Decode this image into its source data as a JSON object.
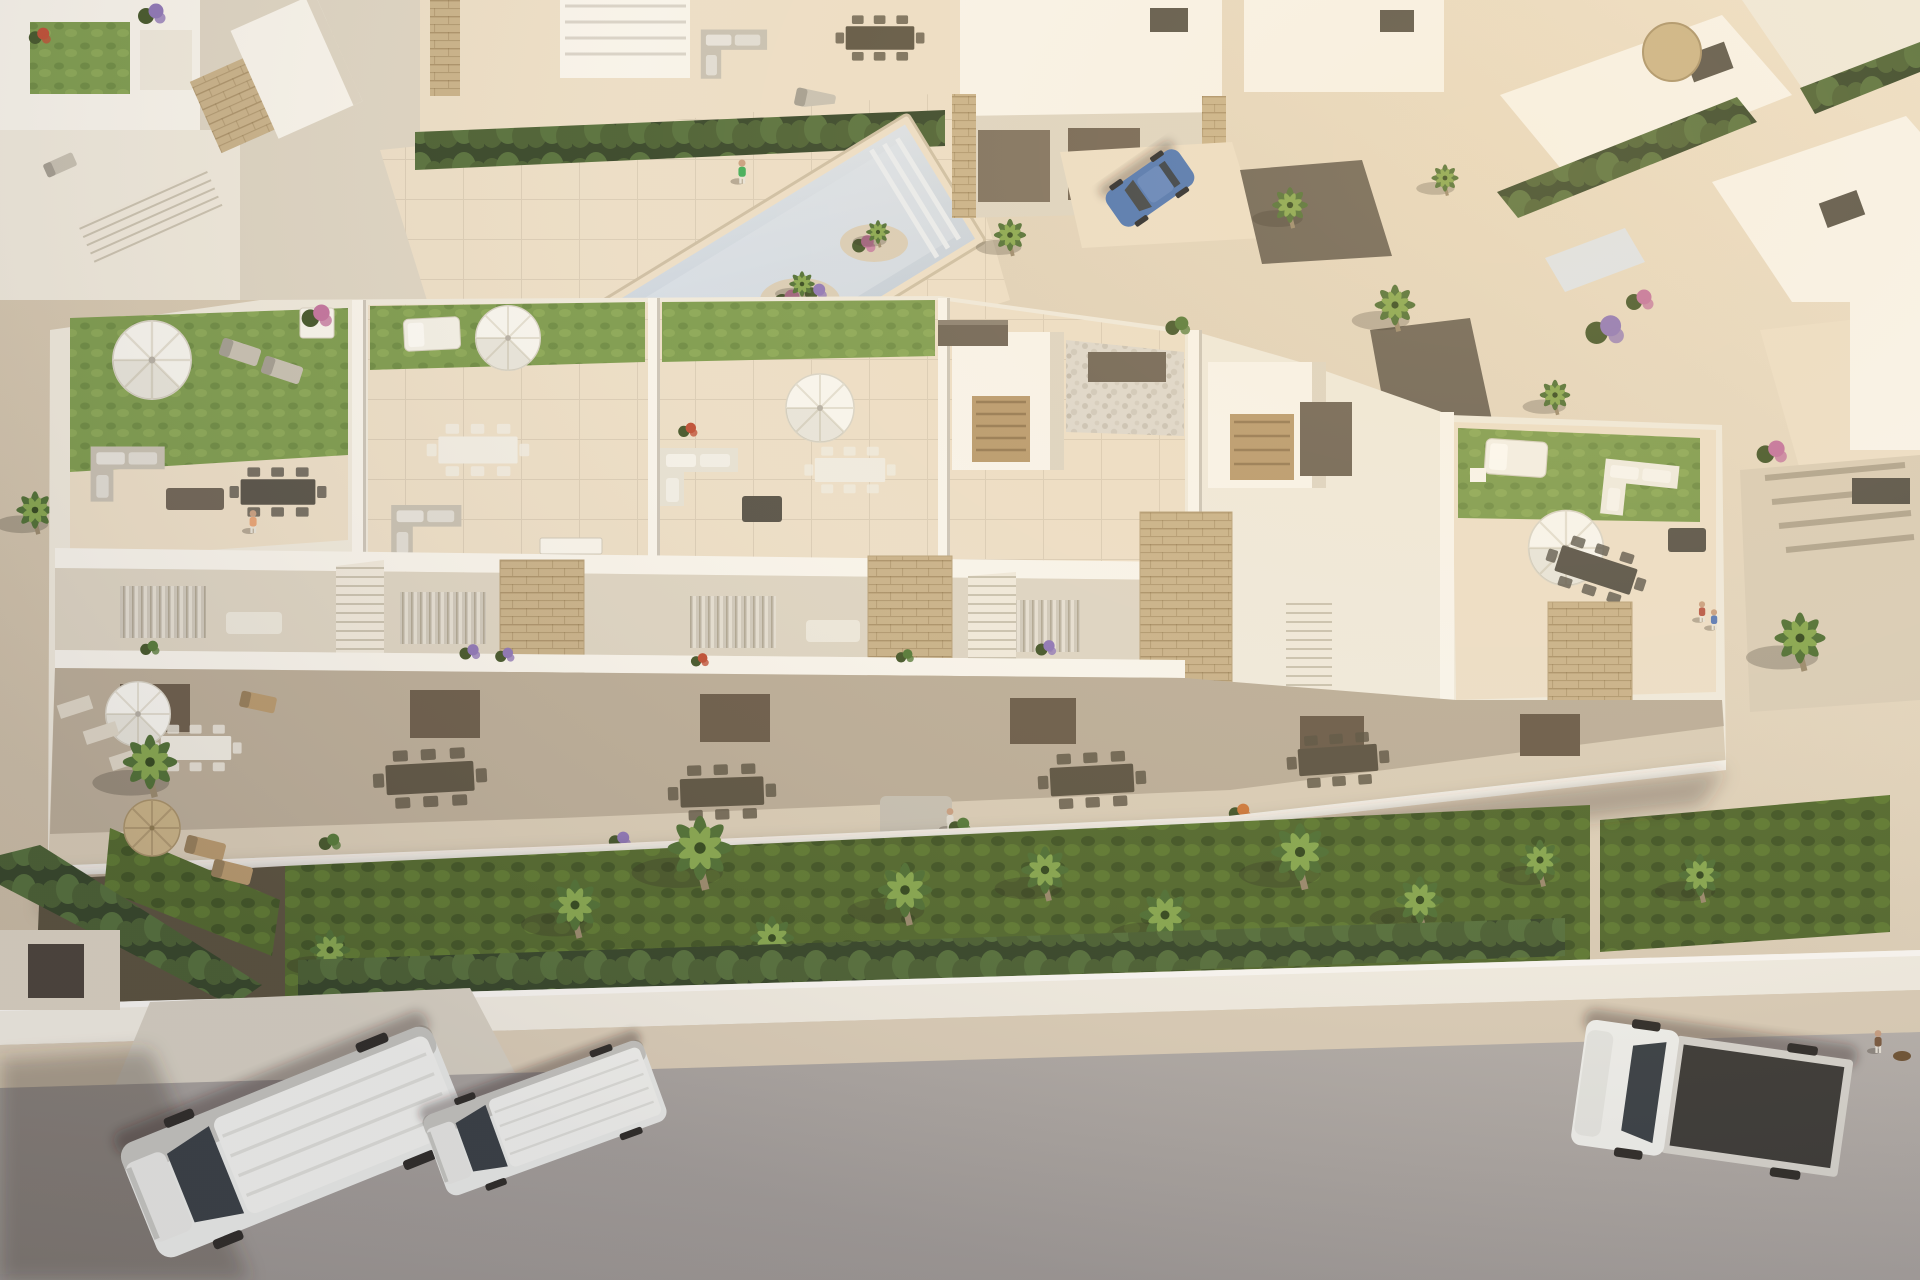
{
  "scene": {
    "title": "Aerial render of a modern white residential complex",
    "description": "Golden-hour aerial 3D visualization of a row of white Mediterranean townhouses with private rooftop terraces, balconies and ground-floor gardens; a communal pool plaza with palm islands sits among upper villas; a front lawn with palm trees and a cypress hedge borders a grey street with two parked vans and a flatbed truck",
    "view": "aerial three-quarter",
    "lighting": "low warm sun from the upper right casting soft shadows to the lower left"
  },
  "colors": {
    "paving-light": "#ecdfc9",
    "paving": "#d9cdb8",
    "paving-shade": "#c3b6a0",
    "white-lit": "#f8f5ee",
    "white": "#efeade",
    "white-shade": "#ddd5c5",
    "white-dark": "#b9b1a1",
    "stone": "#c8b28b",
    "stone-dark": "#a8925f",
    "wood": "#b89a6f",
    "wood-dark": "#5d5545",
    "furn-grey": "#c7c1b4",
    "furn-dark": "#57534a",
    "pergola": "#6e6457",
    "turf": "#7d9c50",
    "lawn": "#52692f",
    "hedge": "#4a6034",
    "hedge-dark": "#35462a",
    "palm": "#4f7036",
    "palm-light": "#86a750",
    "trunk": "#9a8a6e",
    "flower-purple": "#8e77b8",
    "flower-pink": "#c2739f",
    "flower-red": "#bf4f37",
    "flower-orange": "#cf7a3d",
    "pool": "#c3cfdd",
    "pool-light": "#dde4ec",
    "road": "#a9a4a1",
    "road-dark": "#8b8784",
    "sidewalk": "#dccfba",
    "wall-white": "#f3efe5",
    "van-body": "#eceeec",
    "glass": "#394046",
    "car-blue": "#4a74b4",
    "truck-bed": "#3b3a37",
    "skin": "#c9a083",
    "shadow": "rgba(70,58,45,0.28)"
  },
  "inventory": {
    "main_building_units": 5,
    "rooftop_terraces": 5,
    "communal_pool": "pale tiled pool with two planted palm islands and corner steps",
    "vehicles": [
      {
        "type": "panel-van",
        "color": "silver-white",
        "location": "street lower-left"
      },
      {
        "type": "compact-van",
        "color": "white",
        "location": "street lower-left"
      },
      {
        "type": "flatbed-truck",
        "color": "white cab with dark bed",
        "location": "street lower-right"
      },
      {
        "type": "hatchback",
        "color": "blue",
        "location": "upper villa driveway"
      }
    ],
    "vegetation": [
      "palm trees",
      "cypress hedge row",
      "clipped hedges",
      "bougainvillea",
      "purple and orange flower beds",
      "rooftop turf lawns"
    ],
    "people_visible": 8,
    "furniture": [
      "white parasols",
      "straw parasol",
      "sun loungers",
      "grey outdoor sofas",
      "white corner sofas",
      "dark wood dining sets",
      "white daybeds"
    ]
  }
}
